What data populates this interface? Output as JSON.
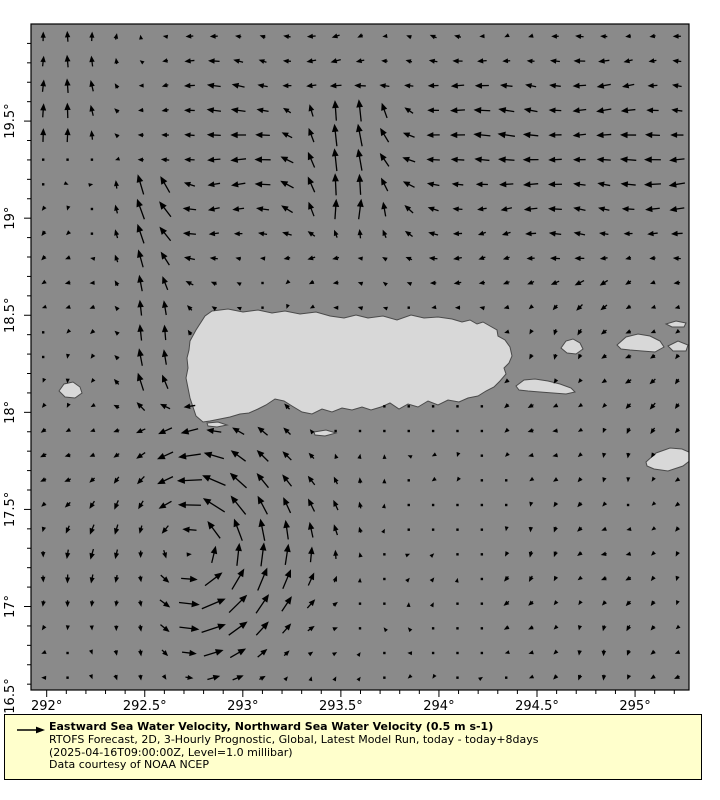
{
  "figure": {
    "background": "#ffffff",
    "ocean_color": "#8a8a8a",
    "land_color": "#d8d8d8",
    "coast_color": "#4a4a4a",
    "arrow_color": "#000000",
    "plot_px": {
      "left": 31,
      "top": 24,
      "right": 689,
      "bottom": 690
    }
  },
  "axes": {
    "lon_min": 291.92,
    "lon_max": 295.275,
    "lat_min": 16.57,
    "lat_max": 20.0,
    "x_ticks": [
      {
        "label": "292°",
        "lon": 292.0
      },
      {
        "label": "292.5°",
        "lon": 292.5
      },
      {
        "label": "293°",
        "lon": 293.0
      },
      {
        "label": "293.5°",
        "lon": 293.5
      },
      {
        "label": "294°",
        "lon": 294.0
      },
      {
        "label": "294.5°",
        "lon": 294.5
      },
      {
        "label": "295°",
        "lon": 295.0
      }
    ],
    "y_ticks": [
      {
        "label": "19.5°",
        "lat": 19.5
      },
      {
        "label": "19°",
        "lat": 19.0
      },
      {
        "label": "18.5°",
        "lat": 18.5
      },
      {
        "label": "18°",
        "lat": 18.0
      },
      {
        "label": "17.5°",
        "lat": 17.5
      },
      {
        "label": "17°",
        "lat": 17.0
      },
      {
        "label": "16.5°",
        "lat": 16.5
      }
    ],
    "minor_step_deg": 0.1
  },
  "legend": {
    "bg": "#ffffcc",
    "border": "#000000",
    "title": "Eastward Sea Water Velocity, Northward Sea Water Velocity (0.5 m s-1)",
    "line2": "RTOFS Forecast, 2D, 3-Hourly Prognostic, Global, Latest Model Run, today - today+8days",
    "line3": "(2025-04-16T09:00:00Z, Level=1.0 millibar)",
    "line4": "Data courtesy of NOAA NCEP"
  },
  "chart_data": {
    "type": "quiver",
    "title": "Eastward Sea Water Velocity, Northward Sea Water Velocity (0.5 m s-1)",
    "reference_vector": {
      "speed_m_s": 0.5,
      "arrow_px": 26
    },
    "grid": {
      "cols": 27,
      "rows": 27
    },
    "region": {
      "lon_min": 291.92,
      "lon_max": 295.275,
      "lat_min": 16.57,
      "lat_max": 20.0
    },
    "flow_features": [
      {
        "kind": "vortex",
        "name": "cyclonic-eddy-southwest",
        "rotation": "ccw",
        "center": [
          292.72,
          17.32
        ],
        "peak_speed": 0.5,
        "core_radius": 0.33,
        "decay": 0.55,
        "west_damp_start": 292.45,
        "west_damp_len": 0.4,
        "west_damp_floor": 0.3
      },
      {
        "kind": "band",
        "name": "westward-current-north-of-pr",
        "u": -0.3,
        "lat_center": 19.35,
        "lat_halfwidth": 0.62,
        "west_fade_start": 292.2,
        "west_fade_len": 0.7
      },
      {
        "kind": "jet_north",
        "name": "northward-limb-meander",
        "lon_center": 293.55,
        "lon_sigma": 0.28,
        "lat_from": 18.85,
        "lat_to": 19.55,
        "v": 0.42,
        "u_offset": 0.26
      },
      {
        "kind": "jet_north",
        "name": "mona-passage-jet",
        "lon_center": 292.52,
        "lon_sigma": 0.17,
        "lat_from": 17.95,
        "lat_to": 19.15,
        "v": 0.4,
        "u_offset": 0.0
      },
      {
        "kind": "jet_north",
        "name": "northwest-corner-flow",
        "lon_center": 292.08,
        "lon_sigma": 0.3,
        "lat_from": 19.3,
        "lat_to": 20.1,
        "v": 0.25,
        "u_offset": 0.0
      },
      {
        "kind": "drift",
        "name": "southeast-weak-drift",
        "u": -0.06,
        "v": -0.07,
        "lat_below": 18.65,
        "lon_above": 294.2
      },
      {
        "kind": "drift",
        "name": "southwest-weak-drift",
        "u": -0.05,
        "v": -0.04,
        "lat_below": 19.0,
        "lon_below": 292.7
      },
      {
        "kind": "noise",
        "name": "mesoscale-variability",
        "amp": 0.035
      }
    ],
    "land_masses": [
      {
        "name": "puerto-rico",
        "polygon_px": [
          [
            190,
            341
          ],
          [
            196,
            330
          ],
          [
            205,
            316
          ],
          [
            212,
            311
          ],
          [
            228,
            309
          ],
          [
            243,
            312
          ],
          [
            258,
            310
          ],
          [
            272,
            313
          ],
          [
            285,
            311
          ],
          [
            300,
            314
          ],
          [
            316,
            312
          ],
          [
            330,
            316
          ],
          [
            344,
            318
          ],
          [
            356,
            315
          ],
          [
            368,
            318
          ],
          [
            383,
            316
          ],
          [
            397,
            320
          ],
          [
            411,
            315
          ],
          [
            424,
            318
          ],
          [
            438,
            317
          ],
          [
            452,
            319
          ],
          [
            462,
            322
          ],
          [
            470,
            320
          ],
          [
            477,
            324
          ],
          [
            483,
            322
          ],
          [
            490,
            326
          ],
          [
            497,
            330
          ],
          [
            498,
            336
          ],
          [
            505,
            340
          ],
          [
            510,
            347
          ],
          [
            512,
            356
          ],
          [
            509,
            363
          ],
          [
            504,
            368
          ],
          [
            506,
            374
          ],
          [
            500,
            381
          ],
          [
            494,
            387
          ],
          [
            486,
            391
          ],
          [
            478,
            396
          ],
          [
            468,
            398
          ],
          [
            459,
            402
          ],
          [
            448,
            400
          ],
          [
            438,
            405
          ],
          [
            428,
            401
          ],
          [
            418,
            407
          ],
          [
            408,
            404
          ],
          [
            399,
            409
          ],
          [
            390,
            403
          ],
          [
            381,
            407
          ],
          [
            371,
            410
          ],
          [
            362,
            407
          ],
          [
            352,
            410
          ],
          [
            342,
            408
          ],
          [
            332,
            412
          ],
          [
            322,
            409
          ],
          [
            312,
            414
          ],
          [
            302,
            412
          ],
          [
            292,
            406
          ],
          [
            284,
            401
          ],
          [
            275,
            399
          ],
          [
            266,
            405
          ],
          [
            258,
            409
          ],
          [
            249,
            413
          ],
          [
            240,
            414
          ],
          [
            230,
            417
          ],
          [
            220,
            419
          ],
          [
            210,
            421
          ],
          [
            203,
            422
          ],
          [
            196,
            416
          ],
          [
            193,
            407
          ],
          [
            190,
            398
          ],
          [
            188,
            388
          ],
          [
            186,
            378
          ],
          [
            188,
            368
          ],
          [
            187,
            358
          ],
          [
            189,
            350
          ]
        ]
      },
      {
        "name": "mona-island",
        "polygon_px": [
          [
            59,
            391
          ],
          [
            64,
            384
          ],
          [
            73,
            382
          ],
          [
            80,
            387
          ],
          [
            82,
            393
          ],
          [
            75,
            398
          ],
          [
            65,
            397
          ]
        ]
      },
      {
        "name": "vieques",
        "polygon_px": [
          [
            516,
            386
          ],
          [
            524,
            380
          ],
          [
            535,
            379
          ],
          [
            548,
            381
          ],
          [
            560,
            384
          ],
          [
            571,
            388
          ],
          [
            575,
            392
          ],
          [
            566,
            394
          ],
          [
            553,
            393
          ],
          [
            540,
            392
          ],
          [
            528,
            391
          ],
          [
            519,
            390
          ]
        ]
      },
      {
        "name": "culebra",
        "polygon_px": [
          [
            561,
            348
          ],
          [
            566,
            341
          ],
          [
            573,
            339
          ],
          [
            580,
            343
          ],
          [
            583,
            349
          ],
          [
            576,
            354
          ],
          [
            567,
            353
          ]
        ]
      },
      {
        "name": "st-thomas-group",
        "polygon_px": [
          [
            617,
            345
          ],
          [
            626,
            337
          ],
          [
            638,
            334
          ],
          [
            650,
            336
          ],
          [
            660,
            341
          ],
          [
            664,
            347
          ],
          [
            655,
            352
          ],
          [
            642,
            351
          ],
          [
            630,
            350
          ],
          [
            621,
            349
          ]
        ]
      },
      {
        "name": "tortola-sliver",
        "polygon_px": [
          [
            666,
            324
          ],
          [
            676,
            321
          ],
          [
            686,
            323
          ],
          [
            684,
            327
          ],
          [
            672,
            327
          ]
        ]
      },
      {
        "name": "virgin-gorda",
        "polygon_px": [
          [
            668,
            346
          ],
          [
            678,
            341
          ],
          [
            688,
            345
          ],
          [
            686,
            351
          ],
          [
            673,
            351
          ]
        ]
      },
      {
        "name": "st-croix",
        "polygon_px": [
          [
            646,
            462
          ],
          [
            656,
            453
          ],
          [
            670,
            448
          ],
          [
            682,
            449
          ],
          [
            691,
            453
          ],
          [
            692,
            459
          ],
          [
            683,
            466
          ],
          [
            668,
            471
          ],
          [
            654,
            469
          ],
          [
            647,
            466
          ]
        ]
      },
      {
        "name": "islets-sw-pr",
        "polygon_px": [
          [
            207,
            423
          ],
          [
            218,
            422
          ],
          [
            227,
            425
          ],
          [
            217,
            427
          ],
          [
            208,
            426
          ]
        ]
      },
      {
        "name": "caja-de-muertos",
        "polygon_px": [
          [
            314,
            432
          ],
          [
            326,
            430
          ],
          [
            336,
            433
          ],
          [
            325,
            436
          ],
          [
            315,
            435
          ]
        ]
      }
    ]
  }
}
